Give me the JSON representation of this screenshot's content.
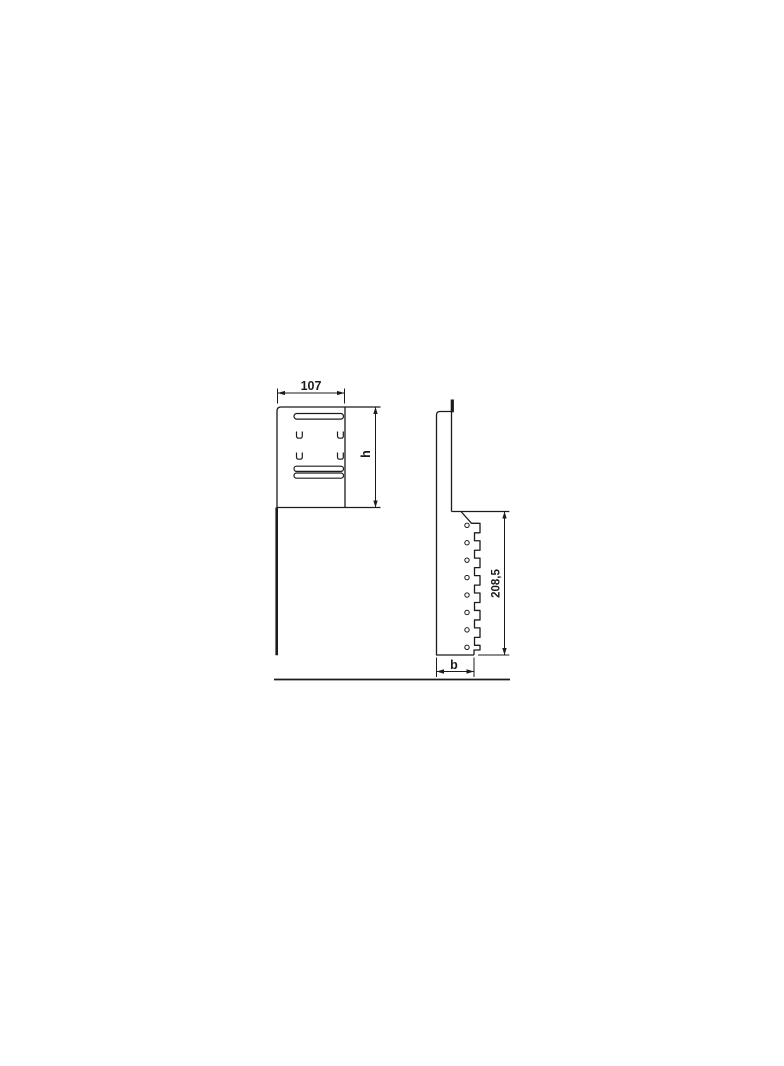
{
  "colors": {
    "background": "#ffffff",
    "ink": "#1b1b1b"
  },
  "drawing_type": "technical-dimension-drawing",
  "front_view": {
    "width_dim_label": "107",
    "height_dim_label": "h",
    "slot_count": 3,
    "clip_count": 4
  },
  "side_view": {
    "height_dim_label": "208,5",
    "depth_dim_label": "b",
    "hole_count": 8,
    "tooth_count": 8
  }
}
